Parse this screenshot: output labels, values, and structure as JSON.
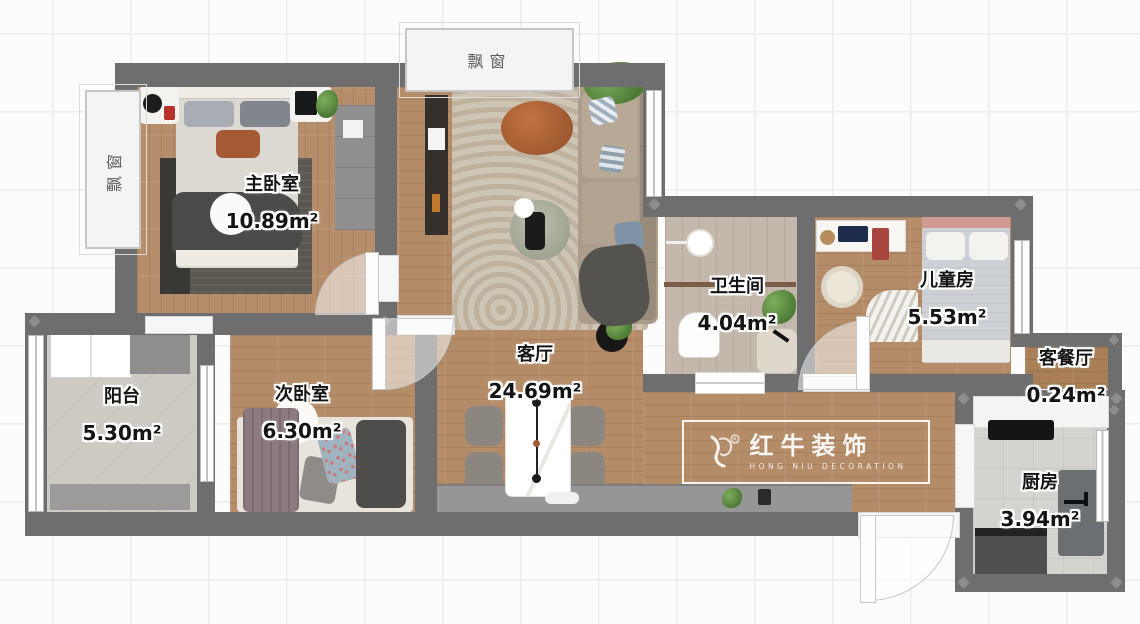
{
  "rooms": {
    "master": {
      "name": "主卧室",
      "area": "10.89m²"
    },
    "living": {
      "name": "客厅",
      "area": "24.69m²"
    },
    "bathroom": {
      "name": "卫生间",
      "area": "4.04m²"
    },
    "kids": {
      "name": "儿童房",
      "area": "5.53m²"
    },
    "nook": {
      "name": "客餐厅",
      "area": "0.24m²"
    },
    "balcony": {
      "name": "阳台",
      "area": "5.30m²"
    },
    "second": {
      "name": "次卧室",
      "area": "6.30m²"
    },
    "kitchen": {
      "name": "厨房",
      "area": "3.94m²"
    }
  },
  "bay_windows": {
    "top": "飘窗",
    "left": "飘窗"
  },
  "watermark": {
    "brand": "红牛装饰",
    "subtitle": "HONG NIU DECORATION"
  },
  "colors": {
    "wall": "#6e6e6e",
    "wood": "#b58c68",
    "accent_orange": "#a35a35",
    "rug": "#c9beac"
  }
}
